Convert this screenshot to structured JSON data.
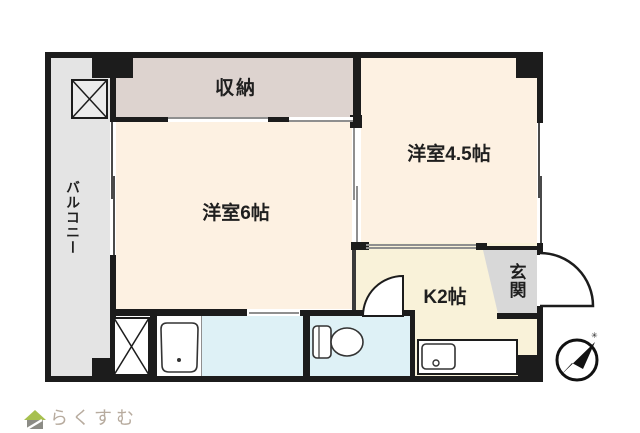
{
  "rooms": {
    "balcony": "バルコニー",
    "storage": "収納",
    "western_room_45": "洋室4.5帖",
    "western_room_6": "洋室6帖",
    "kitchen": "K2帖",
    "entrance": "玄関"
  },
  "fixtures": {
    "bathtub": "bathtub",
    "toilet": "toilet",
    "kitchen_sink": "kitchen-sink",
    "washing_machine_space": "crossed-box",
    "outdoor_unit_space": "crossed-box"
  },
  "compass": {
    "north_mark": "✳"
  },
  "branding": {
    "logo_text": "らくすむ"
  },
  "colors": {
    "wall": "#1c1c1c",
    "room_cream": "#fdf1e2",
    "kitchen_cream": "#f9f2d9",
    "storage_pink": "#ddd3cf",
    "balcony_gray": "#e4e4e4",
    "entrance_gray": "#d8d8d8",
    "wet_area_blue": "#def1f6",
    "logo_text": "#b7ab9e",
    "logo_roof_green": "#a7c04f",
    "logo_body_gray": "#8c8c86"
  }
}
